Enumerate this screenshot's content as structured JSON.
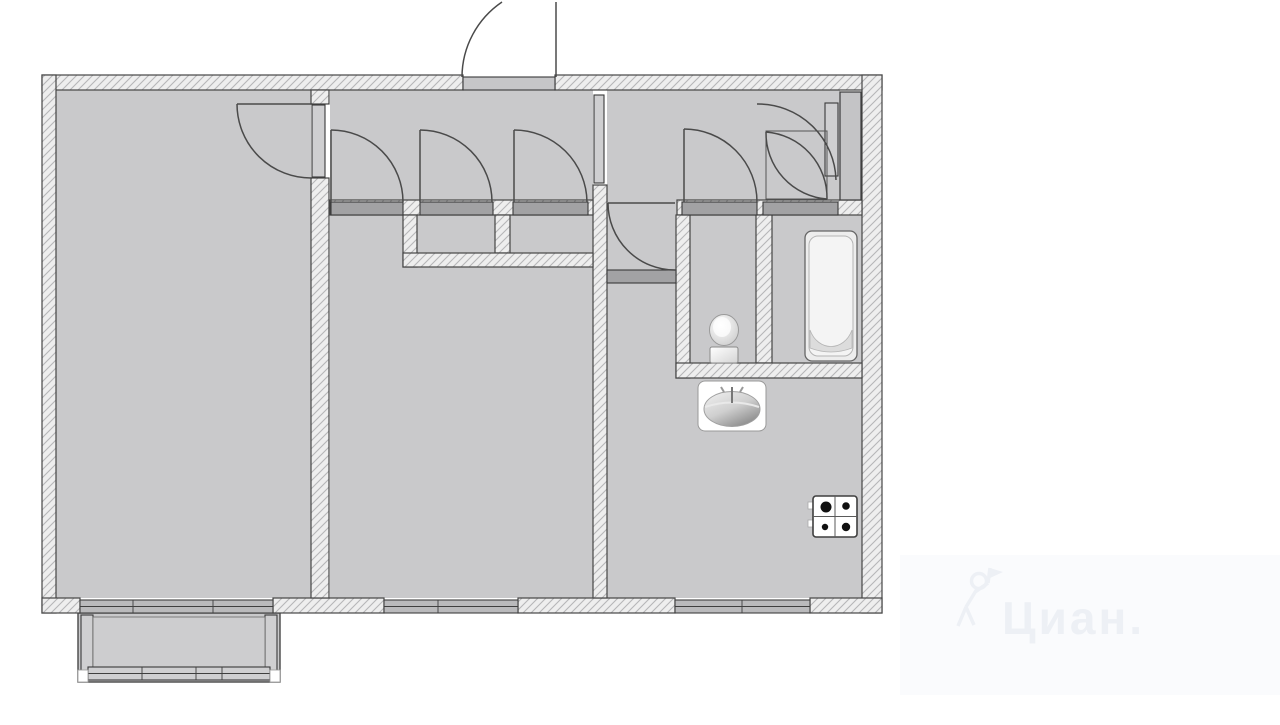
{
  "watermark": {
    "text": "Циан."
  },
  "colors": {
    "background": "#ffffff",
    "room_fill": "#c9c9cb",
    "wall_fill": "#eeeeee",
    "wall_hatch": "#b6b6b8",
    "wall_outline": "#454545",
    "door_line": "#4a4a4a",
    "sill_fill": "#a2a2a4",
    "window_fill": "#bababc",
    "panel_fill": "#cfcfd1",
    "watermark_color": "#edf0f5"
  },
  "plan": {
    "type": "apartment-floor-plan",
    "rooms": [
      {
        "id": "living-room"
      },
      {
        "id": "bedroom"
      },
      {
        "id": "hallway"
      },
      {
        "id": "vestibule"
      },
      {
        "id": "kitchen"
      },
      {
        "id": "toilet"
      },
      {
        "id": "bathroom"
      },
      {
        "id": "closet-1"
      },
      {
        "id": "closet-2"
      },
      {
        "id": "balcony"
      }
    ],
    "fixtures": [
      {
        "id": "toilet-fixture"
      },
      {
        "id": "bathtub"
      },
      {
        "id": "kitchen-sink"
      },
      {
        "id": "gas-stove-4-burner"
      }
    ],
    "doors": [
      {
        "id": "entrance-door"
      },
      {
        "id": "living-room-door"
      },
      {
        "id": "bedroom-door"
      },
      {
        "id": "closet-door-1"
      },
      {
        "id": "closet-door-2"
      },
      {
        "id": "toilet-door"
      },
      {
        "id": "bathroom-door"
      },
      {
        "id": "kitchen-door"
      }
    ],
    "windows": [
      {
        "id": "living-room-balcony-window"
      },
      {
        "id": "bedroom-window"
      },
      {
        "id": "kitchen-window"
      }
    ]
  }
}
